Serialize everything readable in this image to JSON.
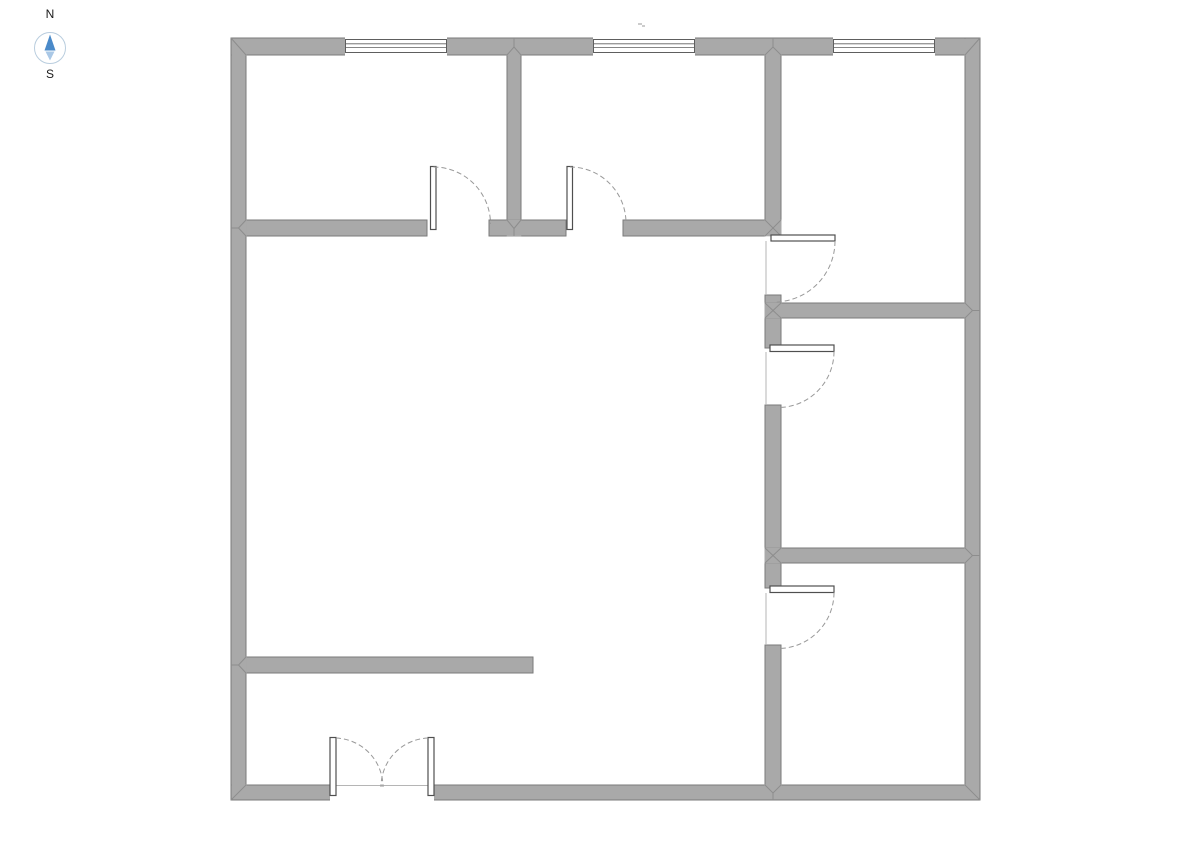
{
  "canvas": {
    "width": 1191,
    "height": 842,
    "background": "#ffffff"
  },
  "compass": {
    "north_label": "N",
    "south_label": "S",
    "ring_color": "#b9cdde",
    "needle_north_color": "#4a8ac9",
    "needle_south_color": "#aac8e6",
    "label_color": "#1a1a1a"
  },
  "floorplan": {
    "wall_fill": "#a9a9a9",
    "wall_stroke": "#7a7a7a",
    "seam_color": "#8d8d8d",
    "window_stroke": "#5e5e5e",
    "door_leaf_stroke": "#4f4f4f",
    "door_arc_color": "#999999",
    "face_line_color": "#b5b5b5",
    "stray_mark_color": "#cccccc",
    "walls": [
      {
        "x": 231,
        "y": 38,
        "w": 15,
        "h": 762
      },
      {
        "x": 231,
        "y": 38,
        "w": 749,
        "h": 17
      },
      {
        "x": 965,
        "y": 38,
        "w": 15,
        "h": 762
      },
      {
        "x": 231,
        "y": 785,
        "w": 749,
        "h": 15
      },
      {
        "x": 507,
        "y": 55,
        "w": 14,
        "h": 165
      },
      {
        "x": 246,
        "y": 220,
        "w": 181,
        "h": 16
      },
      {
        "x": 489,
        "y": 220,
        "w": 77,
        "h": 16
      },
      {
        "x": 623,
        "y": 220,
        "w": 142,
        "h": 16
      },
      {
        "x": 765,
        "y": 55,
        "w": 16,
        "h": 180
      },
      {
        "x": 765,
        "y": 295,
        "w": 16,
        "h": 53
      },
      {
        "x": 765,
        "y": 405,
        "w": 16,
        "h": 183
      },
      {
        "x": 765,
        "y": 645,
        "w": 16,
        "h": 140
      },
      {
        "x": 765,
        "y": 303,
        "w": 200,
        "h": 15
      },
      {
        "x": 765,
        "y": 548,
        "w": 200,
        "h": 15
      },
      {
        "x": 246,
        "y": 657,
        "w": 287,
        "h": 16
      }
    ],
    "joint_covers": [
      {
        "x": 231.7,
        "y": 38.7,
        "w": 14.8,
        "h": 16.8
      },
      {
        "x": 506.7,
        "y": 38.7,
        "w": 14.6,
        "h": 16.8
      },
      {
        "x": 764.5,
        "y": 38.7,
        "w": 17.0,
        "h": 16.8
      },
      {
        "x": 964.5,
        "y": 38.7,
        "w": 15.0,
        "h": 16.8
      },
      {
        "x": 231.7,
        "y": 219.7,
        "w": 15.0,
        "h": 16.6
      },
      {
        "x": 506.7,
        "y": 219.7,
        "w": 14.6,
        "h": 16.6
      },
      {
        "x": 764.5,
        "y": 219.7,
        "w": 17.0,
        "h": 16.6
      },
      {
        "x": 764.5,
        "y": 302.7,
        "w": 17.0,
        "h": 15.6
      },
      {
        "x": 964.5,
        "y": 302.7,
        "w": 15.0,
        "h": 15.6
      },
      {
        "x": 764.5,
        "y": 547.7,
        "w": 17.0,
        "h": 15.6
      },
      {
        "x": 964.5,
        "y": 547.7,
        "w": 15.0,
        "h": 15.6
      },
      {
        "x": 231.7,
        "y": 656.7,
        "w": 15.0,
        "h": 16.6
      },
      {
        "x": 231.7,
        "y": 784.5,
        "w": 14.8,
        "h": 15.0
      },
      {
        "x": 764.5,
        "y": 784.5,
        "w": 17.0,
        "h": 15.0
      },
      {
        "x": 964.5,
        "y": 784.5,
        "w": 15.0,
        "h": 15.0
      }
    ],
    "seams": [
      {
        "x1": 231,
        "y1": 38,
        "x2": 246,
        "y2": 55
      },
      {
        "x1": 507,
        "y1": 55,
        "x2": 514,
        "y2": 47
      },
      {
        "x1": 521,
        "y1": 55,
        "x2": 514,
        "y2": 47
      },
      {
        "x1": 514,
        "y1": 47,
        "x2": 514,
        "y2": 38
      },
      {
        "x1": 765,
        "y1": 55,
        "x2": 773,
        "y2": 47
      },
      {
        "x1": 781,
        "y1": 55,
        "x2": 773,
        "y2": 47
      },
      {
        "x1": 773,
        "y1": 47,
        "x2": 773,
        "y2": 38
      },
      {
        "x1": 980,
        "y1": 38,
        "x2": 965,
        "y2": 55
      },
      {
        "x1": 246,
        "y1": 220,
        "x2": 238.5,
        "y2": 228
      },
      {
        "x1": 246,
        "y1": 236,
        "x2": 238.5,
        "y2": 228
      },
      {
        "x1": 238.5,
        "y1": 228,
        "x2": 231,
        "y2": 228
      },
      {
        "x1": 507,
        "y1": 220,
        "x2": 514,
        "y2": 228.5
      },
      {
        "x1": 521,
        "y1": 220,
        "x2": 514,
        "y2": 228.5
      },
      {
        "x1": 514,
        "y1": 228.5,
        "x2": 514,
        "y2": 236
      },
      {
        "x1": 765,
        "y1": 220,
        "x2": 781,
        "y2": 236
      },
      {
        "x1": 781,
        "y1": 220,
        "x2": 765,
        "y2": 236
      },
      {
        "x1": 765,
        "y1": 303,
        "x2": 781,
        "y2": 318
      },
      {
        "x1": 781,
        "y1": 303,
        "x2": 765,
        "y2": 318
      },
      {
        "x1": 965,
        "y1": 303,
        "x2": 972.5,
        "y2": 310.5
      },
      {
        "x1": 965,
        "y1": 318,
        "x2": 972.5,
        "y2": 310.5
      },
      {
        "x1": 972.5,
        "y1": 310.5,
        "x2": 980,
        "y2": 310.5
      },
      {
        "x1": 765,
        "y1": 548,
        "x2": 781,
        "y2": 563
      },
      {
        "x1": 781,
        "y1": 548,
        "x2": 765,
        "y2": 563
      },
      {
        "x1": 965,
        "y1": 548,
        "x2": 972.5,
        "y2": 555.5
      },
      {
        "x1": 965,
        "y1": 563,
        "x2": 972.5,
        "y2": 555.5
      },
      {
        "x1": 972.5,
        "y1": 555.5,
        "x2": 980,
        "y2": 555.5
      },
      {
        "x1": 246,
        "y1": 657,
        "x2": 238.5,
        "y2": 665
      },
      {
        "x1": 246,
        "y1": 673,
        "x2": 238.5,
        "y2": 665
      },
      {
        "x1": 238.5,
        "y1": 665,
        "x2": 231,
        "y2": 665
      },
      {
        "x1": 231,
        "y1": 800,
        "x2": 246,
        "y2": 785
      },
      {
        "x1": 765,
        "y1": 785,
        "x2": 773,
        "y2": 793
      },
      {
        "x1": 781,
        "y1": 785,
        "x2": 773,
        "y2": 793
      },
      {
        "x1": 773,
        "y1": 793,
        "x2": 773,
        "y2": 800
      },
      {
        "x1": 980,
        "y1": 800,
        "x2": 965,
        "y2": 785
      }
    ],
    "windows": [
      {
        "x": 345,
        "y": 38,
        "w": 102,
        "h": 17
      },
      {
        "x": 593,
        "y": 38,
        "w": 102,
        "h": 17
      },
      {
        "x": 833,
        "y": 38,
        "w": 102,
        "h": 17
      }
    ],
    "wall_gaps": [
      {
        "x": 330,
        "y": 784.4,
        "w": 104,
        "h": 16.2
      }
    ],
    "face_lines": [
      {
        "x1": 766,
        "y1": 241,
        "x2": 766,
        "y2": 295
      },
      {
        "x1": 766,
        "y1": 352,
        "x2": 766,
        "y2": 405
      },
      {
        "x1": 766,
        "y1": 593,
        "x2": 766,
        "y2": 645
      },
      {
        "x1": 336,
        "y1": 785.5,
        "x2": 428,
        "y2": 785.5
      }
    ],
    "doors": [
      {
        "leaf": {
          "x": 430.5,
          "y": 166.5,
          "w": 5.5,
          "h": 63
        },
        "arc": "M433.5,167 A57,57 0 0 1 490.5,224"
      },
      {
        "leaf": {
          "x": 567,
          "y": 166.5,
          "w": 5.5,
          "h": 63
        },
        "arc": "M570,167 A56,56 0 0 1 626,223"
      },
      {
        "leaf": {
          "x": 771,
          "y": 235,
          "w": 64,
          "h": 6
        },
        "arc": "M835,241 A61,61 0 0 1 774,302"
      },
      {
        "leaf": {
          "x": 770,
          "y": 345,
          "w": 64,
          "h": 6.5
        },
        "arc": "M834,351.5 A56,56 0 0 1 778,407.5"
      },
      {
        "leaf": {
          "x": 770,
          "y": 586,
          "w": 64,
          "h": 6.5
        },
        "arc": "M834,592.5 A56,56 0 0 1 778,648.5"
      },
      {
        "leaf": {
          "x": 330,
          "y": 737.5,
          "w": 6,
          "h": 58
        },
        "arc": "M336,738 A49,49 0 0 1 383,787"
      },
      {
        "leaf": {
          "x": 428,
          "y": 737.5,
          "w": 6,
          "h": 58
        },
        "arc": "M428,738 A49,49 0 0 0 381,787"
      }
    ],
    "stray_marks": [
      {
        "x": 638,
        "y": 23,
        "w": 4,
        "h": 2
      },
      {
        "x": 642,
        "y": 25,
        "w": 3,
        "h": 2
      }
    ]
  }
}
